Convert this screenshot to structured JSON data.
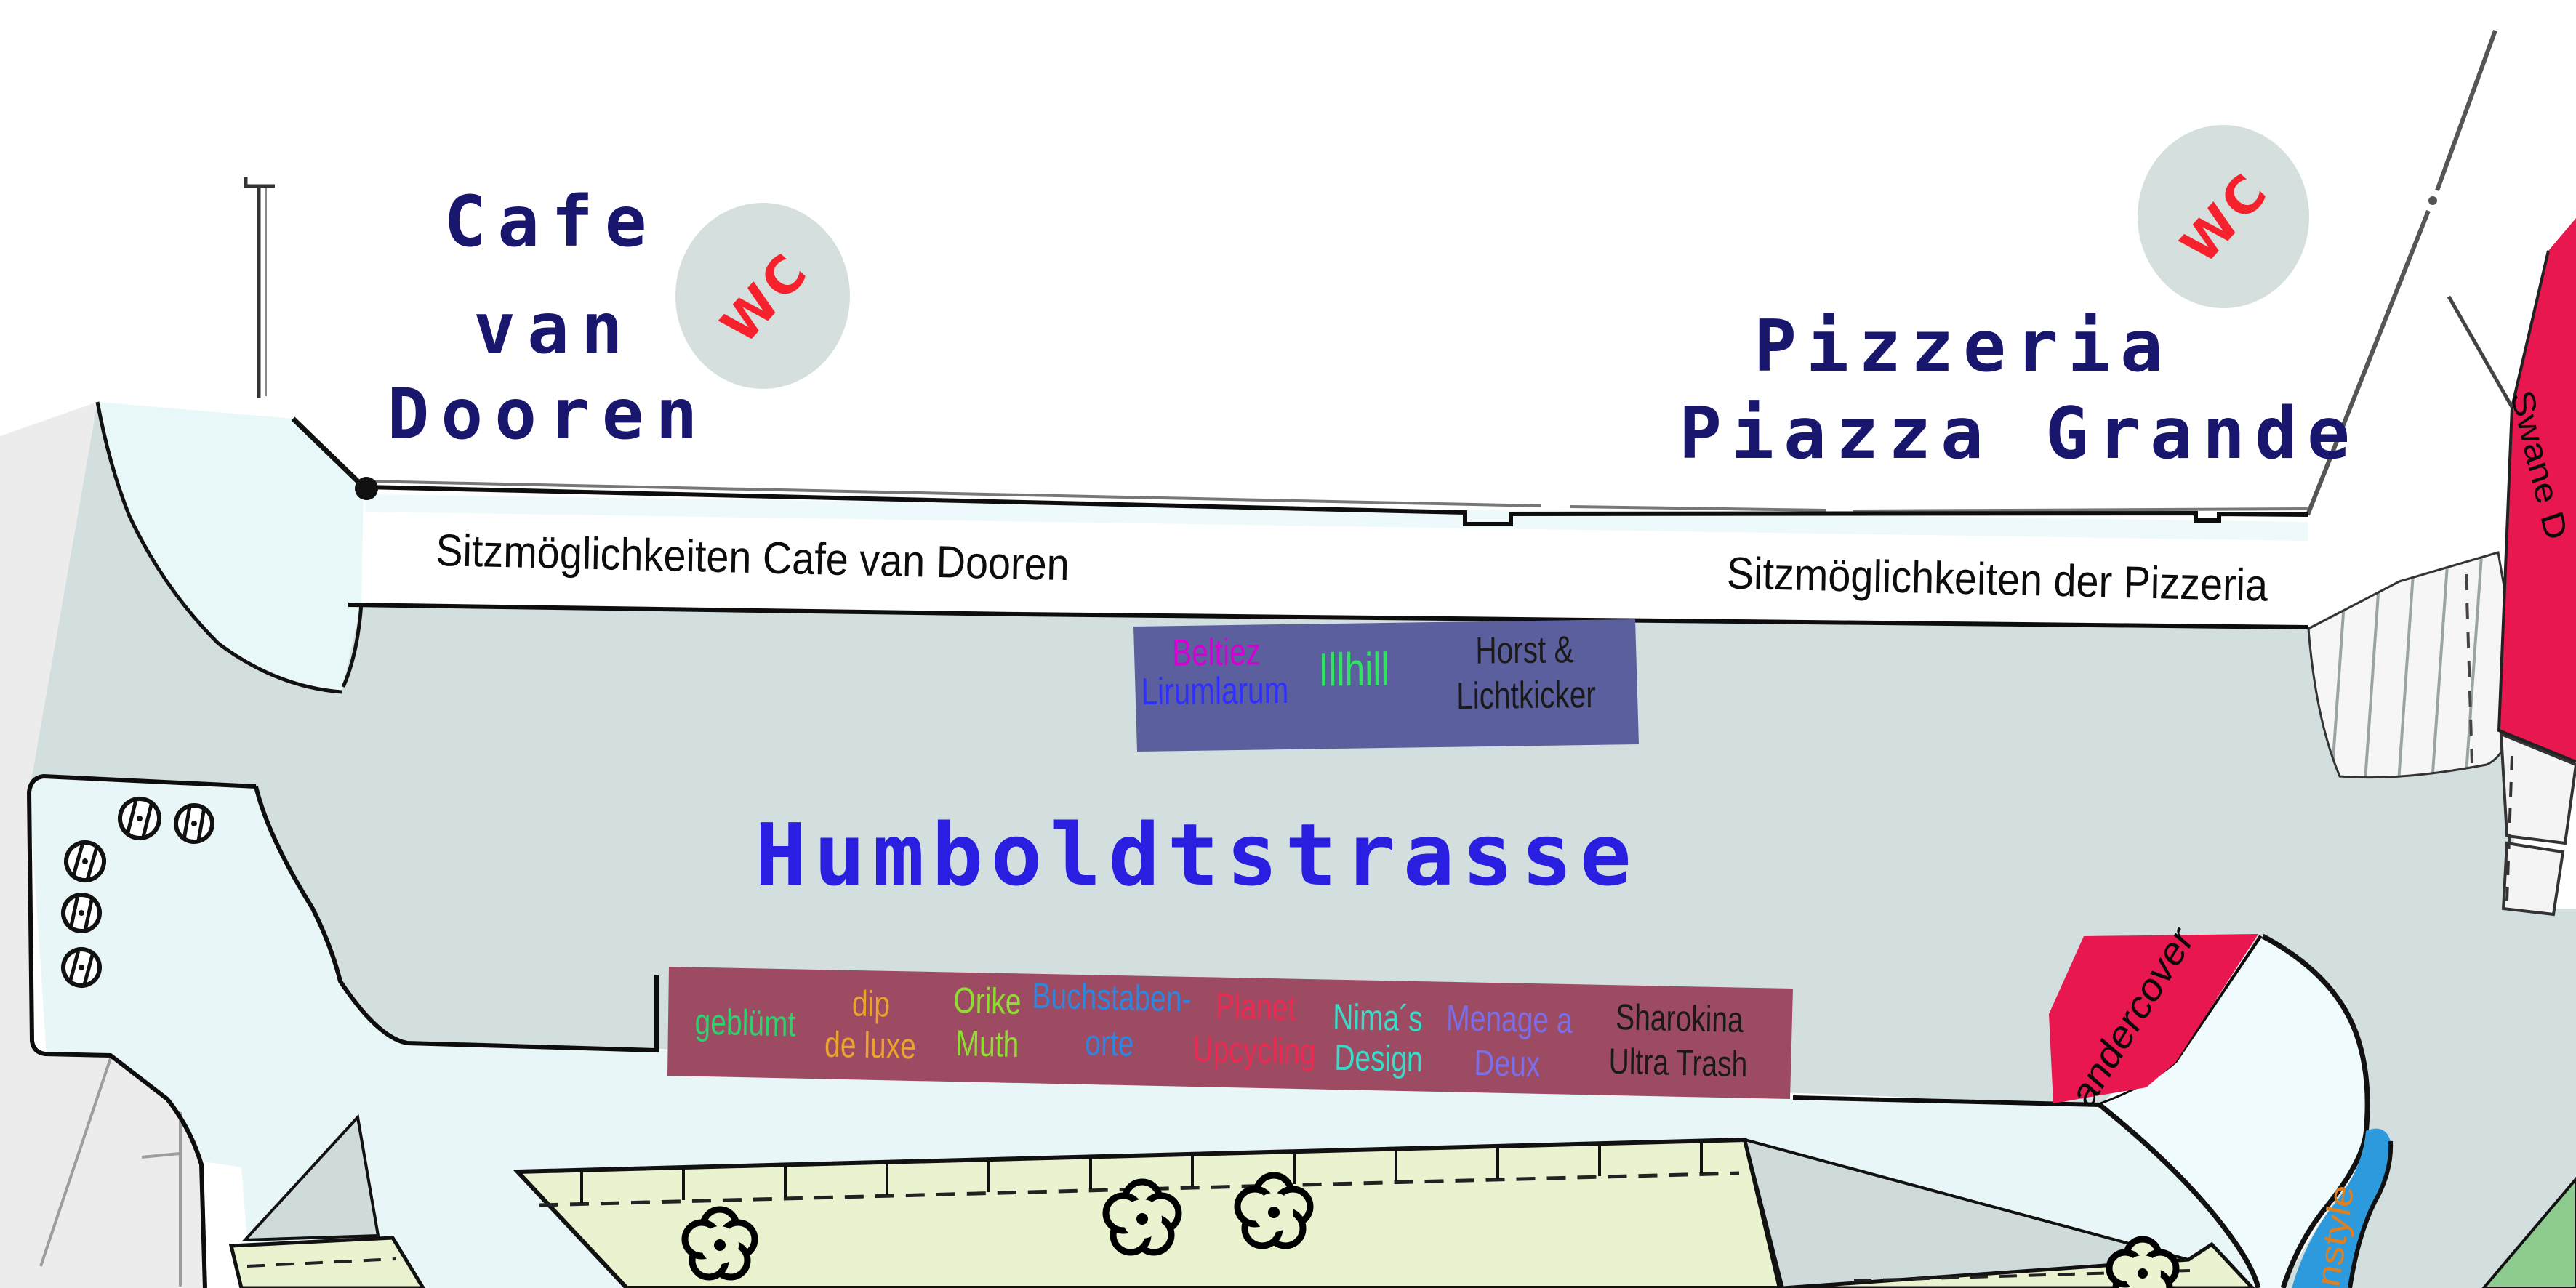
{
  "map": {
    "buildings": {
      "cafe": {
        "line1": "Cafe",
        "line2": "van",
        "line3": "Dooren"
      },
      "pizzeria": {
        "line1": "Pizzeria",
        "line2": "Piazza Grande"
      }
    },
    "wc_label": "WC",
    "seating": {
      "cafe": "Sitzmöglichkeiten Cafe van Dooren",
      "pizzeria": "Sitzmöglichkeiten der Pizzeria"
    },
    "street_label": "Humboldtstrasse",
    "north_stand": {
      "fill_color": "#5c5f9e",
      "labels": [
        {
          "text": "Beltiez",
          "color": "#d400d4"
        },
        {
          "text": "Lirumlarum",
          "color": "#2f2fff"
        },
        {
          "text": "Illhill",
          "color": "#2fe35f"
        },
        {
          "text": "Horst &",
          "color": "#1a1a1a"
        },
        {
          "text": "Lichtkicker",
          "color": "#1a1a1a"
        }
      ]
    },
    "south_stand": {
      "fill_color": "#9d4a63",
      "labels": [
        {
          "text": "geblümt",
          "color": "#2fcf6e"
        },
        {
          "text": "dip",
          "color": "#eaa42e"
        },
        {
          "text": "de luxe",
          "color": "#eaa42e"
        },
        {
          "text": "Orike",
          "color": "#8fdd30"
        },
        {
          "text": "Muth",
          "color": "#8fdd30"
        },
        {
          "text": "Buchstaben-",
          "color": "#2e86de"
        },
        {
          "text": "orte",
          "color": "#2e86de"
        },
        {
          "text": "Planet",
          "color": "#ea2a50"
        },
        {
          "text": "Upcycling",
          "color": "#ea2a50"
        },
        {
          "text": "Nima´s",
          "color": "#38dcc8"
        },
        {
          "text": "Design",
          "color": "#38dcc8"
        },
        {
          "text": "Menage a",
          "color": "#7a6fe8"
        },
        {
          "text": "Deux",
          "color": "#7a6fe8"
        },
        {
          "text": "Sharokina",
          "color": "#1a1a1a"
        },
        {
          "text": "Ultra Trash",
          "color": "#1a1a1a"
        }
      ]
    },
    "shops": {
      "andercover": {
        "label": "andercover",
        "fill_color": "#e8174f"
      },
      "swane": {
        "label": "Swane D",
        "fill_color": "#e8174f"
      },
      "nstyle": {
        "label": "nstyle",
        "fill_color": "#2d9ade",
        "text_color": "#e07f1e"
      }
    },
    "colors": {
      "street_gray": "#d3dedf",
      "plaza_ice": "#e9f6f7",
      "garden_green": "#e9f3cf",
      "wc_circle": "#d5e0de"
    }
  }
}
